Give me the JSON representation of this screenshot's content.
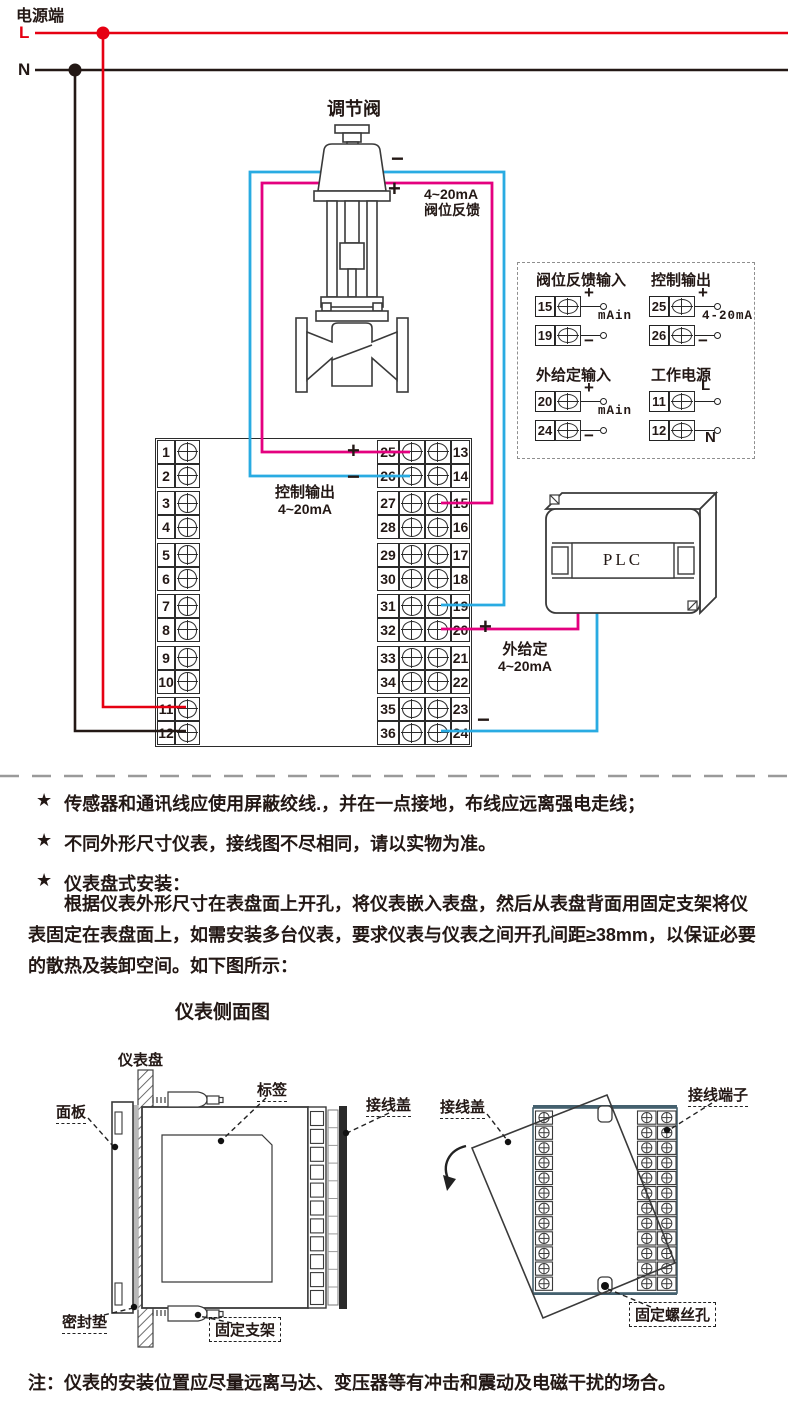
{
  "power": {
    "title": "电源端",
    "l": "L",
    "n": "N"
  },
  "valve": {
    "title": "调节阀",
    "minus": "−",
    "plus": "+",
    "feedback_line1": "4~20mA",
    "feedback_line2": "阀位反馈"
  },
  "control_output": {
    "title": "控制输出",
    "range": "4~20mA",
    "plus": "+",
    "minus": "−"
  },
  "external_setpoint": {
    "title": "外给定",
    "range": "4~20mA",
    "plus": "+",
    "minus": "−"
  },
  "plc": {
    "label": "PLC"
  },
  "terminals": {
    "left": [
      "1",
      "2",
      "3",
      "4",
      "5",
      "6",
      "7",
      "8",
      "9",
      "10",
      "11",
      "12"
    ],
    "inner": [
      "25",
      "26",
      "27",
      "28",
      "29",
      "30",
      "31",
      "32",
      "33",
      "34",
      "35",
      "36"
    ],
    "outer": [
      "13",
      "14",
      "15",
      "16",
      "17",
      "18",
      "19",
      "20",
      "21",
      "22",
      "23",
      "24"
    ]
  },
  "legend": {
    "groups": [
      {
        "title": "阀位反馈输入",
        "rows": [
          {
            "num": "15",
            "sign": "+"
          },
          {
            "num": "19",
            "sign": "−"
          }
        ],
        "annotation": "mAin"
      },
      {
        "title": "控制输出",
        "rows": [
          {
            "num": "25",
            "sign": "+"
          },
          {
            "num": "26",
            "sign": "−"
          }
        ],
        "annotation": "4-20mA"
      },
      {
        "title": "外给定输入",
        "rows": [
          {
            "num": "20",
            "sign": "+"
          },
          {
            "num": "24",
            "sign": "−"
          }
        ],
        "annotation": "mAin"
      },
      {
        "title": "工作电源",
        "rows": [
          {
            "num": "11",
            "sign": "L"
          },
          {
            "num": "12",
            "sign": "N"
          }
        ],
        "annotation": ""
      }
    ]
  },
  "notes": {
    "bullet": "★",
    "items": [
      "传感器和通讯线应使用屏蔽绞线.，并在一点接地，布线应远离强电走线；",
      "不同外形尺寸仪表，接线图不尽相同，请以实物为准。",
      "仪表盘式安装："
    ],
    "paragraph": "根据仪表外形尺寸在表盘面上开孔，将仪表嵌入表盘，然后从表盘背面用固定支架将仪表固定在表盘面上，如需安装多台仪表，要求仪表与仪表之间开孔间距≥38mm，以保证必要的散热及装卸空间。如下图所示：",
    "heading": "仪表侧面图",
    "footnote": "注：仪表的安装位置应尽量远离马达、变压器等有冲击和震动及电磁干扰的场合。"
  },
  "side_view": {
    "panel": "仪表盘",
    "front_panel": "面板",
    "sticker": "标签",
    "terminal_cover": "接线盖",
    "gasket": "密封垫",
    "bracket": "固定支架"
  },
  "back_view": {
    "terminal_cover": "接线盖",
    "terminal_block": "接线端子",
    "screw_hole": "固定螺丝孔"
  },
  "colors": {
    "live_red": "#e60012",
    "signal_magenta": "#e4007f",
    "signal_blue": "#29abe2",
    "line_black": "#231815"
  }
}
